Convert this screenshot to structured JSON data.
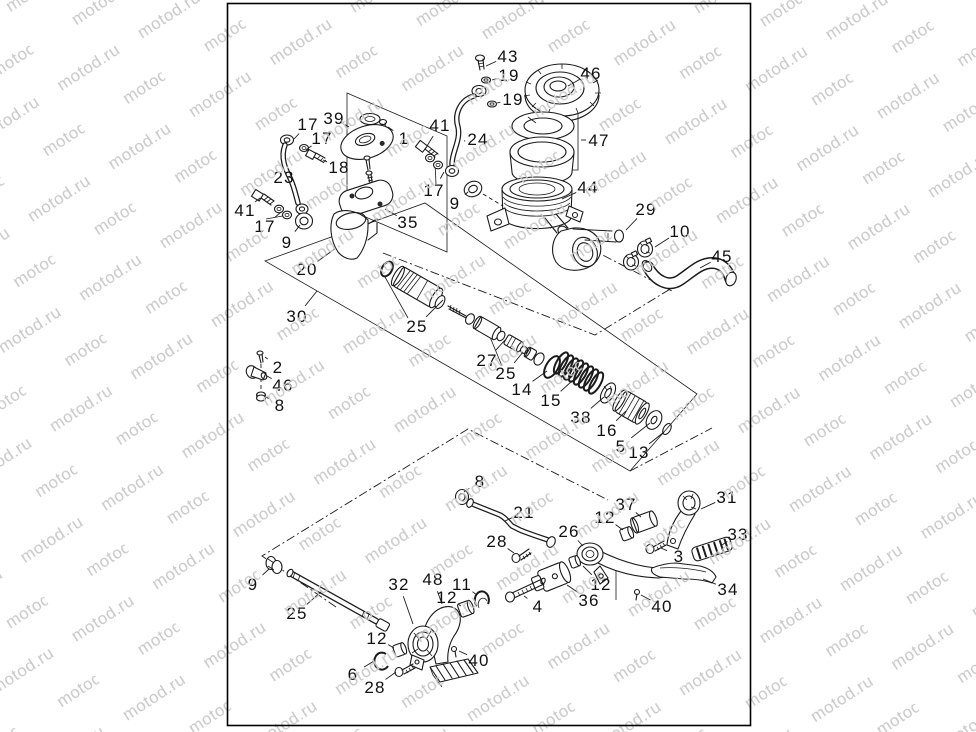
{
  "watermark": {
    "text": "motod.ru",
    "color": "#c8c8c8"
  },
  "frame": {
    "stroke": "#000000"
  },
  "diagram": {
    "type": "exploded-parts-diagram",
    "labels": [
      {
        "n": "43",
        "x": 508,
        "y": 56,
        "tx": 486,
        "ty": 66
      },
      {
        "n": "19",
        "x": 509,
        "y": 75,
        "tx": 492,
        "ty": 80
      },
      {
        "n": "46",
        "x": 591,
        "y": 73,
        "tx": 568,
        "ty": 86
      },
      {
        "n": "19",
        "x": 513,
        "y": 99,
        "tx": 497,
        "ty": 103
      },
      {
        "n": "47",
        "x": 599,
        "y": 140,
        "tx": 581,
        "ty": 140
      },
      {
        "n": "39",
        "x": 334,
        "y": 118,
        "tx": 349,
        "ty": 127
      },
      {
        "n": "17",
        "x": 308,
        "y": 124,
        "tx": 294,
        "ty": 139
      },
      {
        "n": "17",
        "x": 322,
        "y": 138,
        "tx": 306,
        "ty": 150
      },
      {
        "n": "1",
        "x": 404,
        "y": 138,
        "tx": 388,
        "ty": 127
      },
      {
        "n": "41",
        "x": 440,
        "y": 125,
        "tx": 427,
        "ty": 146
      },
      {
        "n": "24",
        "x": 478,
        "y": 139,
        "tx": 464,
        "ty": 141
      },
      {
        "n": "18",
        "x": 339,
        "y": 167,
        "tx": 323,
        "ty": 160
      },
      {
        "n": "23",
        "x": 284,
        "y": 177,
        "tx": 294,
        "ty": 184
      },
      {
        "n": "17",
        "x": 434,
        "y": 190,
        "tx": 444,
        "ty": 172
      },
      {
        "n": "41",
        "x": 245,
        "y": 210,
        "tx": 260,
        "ty": 198
      },
      {
        "n": "9",
        "x": 455,
        "y": 203,
        "tx": 468,
        "ty": 192
      },
      {
        "n": "17",
        "x": 265,
        "y": 226,
        "tx": 281,
        "ty": 212
      },
      {
        "n": "44",
        "x": 588,
        "y": 187,
        "tx": 562,
        "ty": 199
      },
      {
        "n": "9",
        "x": 287,
        "y": 242,
        "tx": 300,
        "ty": 225
      },
      {
        "n": "29",
        "x": 646,
        "y": 209,
        "tx": 626,
        "ty": 230
      },
      {
        "n": "35",
        "x": 408,
        "y": 222,
        "tx": 385,
        "ty": 209
      },
      {
        "n": "10",
        "x": 680,
        "y": 231,
        "tx": 655,
        "ty": 247
      },
      {
        "n": "45",
        "x": 722,
        "y": 256,
        "tx": 700,
        "ty": 268
      },
      {
        "n": "20",
        "x": 307,
        "y": 269,
        "tx": 336,
        "ty": 248
      },
      {
        "n": "30",
        "x": 297,
        "y": 316,
        "tx": 317,
        "ty": 291
      },
      {
        "n": "25",
        "x": 417,
        "y": 326,
        "tx": 443,
        "ty": 300
      },
      {
        "n": "2",
        "x": 278,
        "y": 367,
        "tx": 265,
        "ty": 357
      },
      {
        "n": "27",
        "x": 487,
        "y": 360,
        "tx": 505,
        "ty": 340
      },
      {
        "n": "46",
        "x": 283,
        "y": 385,
        "tx": 267,
        "ty": 376
      },
      {
        "n": "25",
        "x": 506,
        "y": 373,
        "tx": 523,
        "ty": 352
      },
      {
        "n": "14",
        "x": 522,
        "y": 389,
        "tx": 547,
        "ty": 371
      },
      {
        "n": "8",
        "x": 280,
        "y": 405,
        "tx": 266,
        "ty": 397
      },
      {
        "n": "15",
        "x": 551,
        "y": 400,
        "tx": 572,
        "ty": 381
      },
      {
        "n": "38",
        "x": 581,
        "y": 417,
        "tx": 604,
        "ty": 397
      },
      {
        "n": "16",
        "x": 607,
        "y": 430,
        "tx": 626,
        "ty": 411
      },
      {
        "n": "5",
        "x": 621,
        "y": 446,
        "tx": 650,
        "ty": 423
      },
      {
        "n": "13",
        "x": 639,
        "y": 452,
        "tx": 664,
        "ty": 432
      },
      {
        "n": "8",
        "x": 480,
        "y": 481,
        "tx": 464,
        "ty": 492
      },
      {
        "n": "21",
        "x": 524,
        "y": 512,
        "tx": 505,
        "ty": 521
      },
      {
        "n": "37",
        "x": 626,
        "y": 504,
        "tx": 641,
        "ty": 517
      },
      {
        "n": "12",
        "x": 605,
        "y": 517,
        "tx": 623,
        "ty": 530
      },
      {
        "n": "31",
        "x": 727,
        "y": 497,
        "tx": 701,
        "ty": 509
      },
      {
        "n": "26",
        "x": 569,
        "y": 531,
        "tx": 583,
        "ty": 546
      },
      {
        "n": "28",
        "x": 497,
        "y": 541,
        "tx": 514,
        "ty": 553
      },
      {
        "n": "33",
        "x": 738,
        "y": 534,
        "tx": 722,
        "ty": 545
      },
      {
        "n": "3",
        "x": 679,
        "y": 556,
        "tx": 661,
        "ty": 548
      },
      {
        "n": "9",
        "x": 253,
        "y": 584,
        "tx": 269,
        "ty": 569
      },
      {
        "n": "32",
        "x": 399,
        "y": 584,
        "tx": 413,
        "ty": 624
      },
      {
        "n": "48",
        "x": 433,
        "y": 579,
        "tx": 442,
        "ty": 604
      },
      {
        "n": "11",
        "x": 462,
        "y": 584,
        "tx": 477,
        "ty": 595
      },
      {
        "n": "12",
        "x": 447,
        "y": 597,
        "tx": 461,
        "ty": 606
      },
      {
        "n": "12",
        "x": 601,
        "y": 584,
        "tx": 583,
        "ty": 566
      },
      {
        "n": "36",
        "x": 589,
        "y": 600,
        "tx": 567,
        "ty": 585
      },
      {
        "n": "4",
        "x": 538,
        "y": 606,
        "tx": 524,
        "ty": 596
      },
      {
        "n": "34",
        "x": 728,
        "y": 589,
        "tx": 703,
        "ty": 579
      },
      {
        "n": "40",
        "x": 662,
        "y": 606,
        "tx": 641,
        "ty": 595
      },
      {
        "n": "25",
        "x": 297,
        "y": 613,
        "tx": 322,
        "ty": 591
      },
      {
        "n": "12",
        "x": 377,
        "y": 638,
        "tx": 394,
        "ty": 648
      },
      {
        "n": "6",
        "x": 353,
        "y": 674,
        "tx": 374,
        "ty": 661
      },
      {
        "n": "28",
        "x": 375,
        "y": 687,
        "tx": 396,
        "ty": 672
      },
      {
        "n": "40",
        "x": 479,
        "y": 660,
        "tx": 459,
        "ty": 651
      }
    ]
  }
}
